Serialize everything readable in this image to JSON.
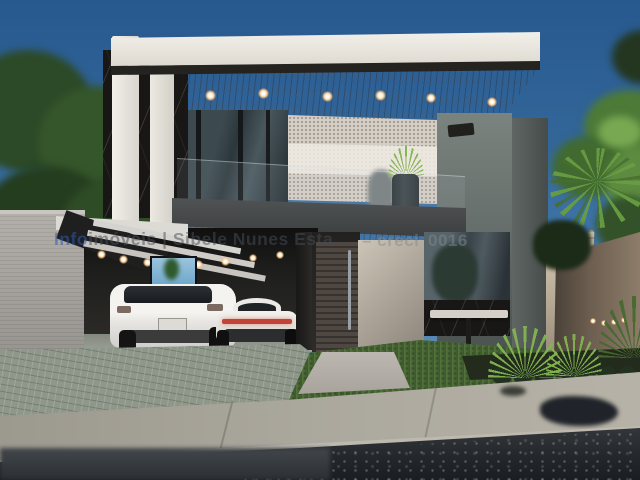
{
  "watermark": {
    "brand_prefix": "Info",
    "brand_rest": "imóveis | Sibele Nunes Esta",
    "creci_label": "– creci",
    "creci_number": "0016"
  },
  "palette": {
    "sky_top": "#27598f",
    "sky_bottom": "#7fa3c2",
    "roof_slab": "#ece9e1",
    "soffit_wood": "#a97c52",
    "marble_panel": "#191716",
    "stone_wall": "#d4cec5",
    "balcony_fascia": "#47494a",
    "door_slats": "#4a4441",
    "entry_wall": "#c0b7ac",
    "house_side_wall": "#6e7674",
    "perimeter_wall_right": "#6b5d4f",
    "perimeter_wall_left": "#a8a5a0",
    "glass": "#44525a",
    "car_body": "#f2f1ee",
    "sports_car_taillight": "#c04438",
    "grass": "#4e6d38",
    "driveway_pavers": "#8f978b",
    "sidewalk": "#a9a69d",
    "road_asphalt": "#26292b"
  }
}
